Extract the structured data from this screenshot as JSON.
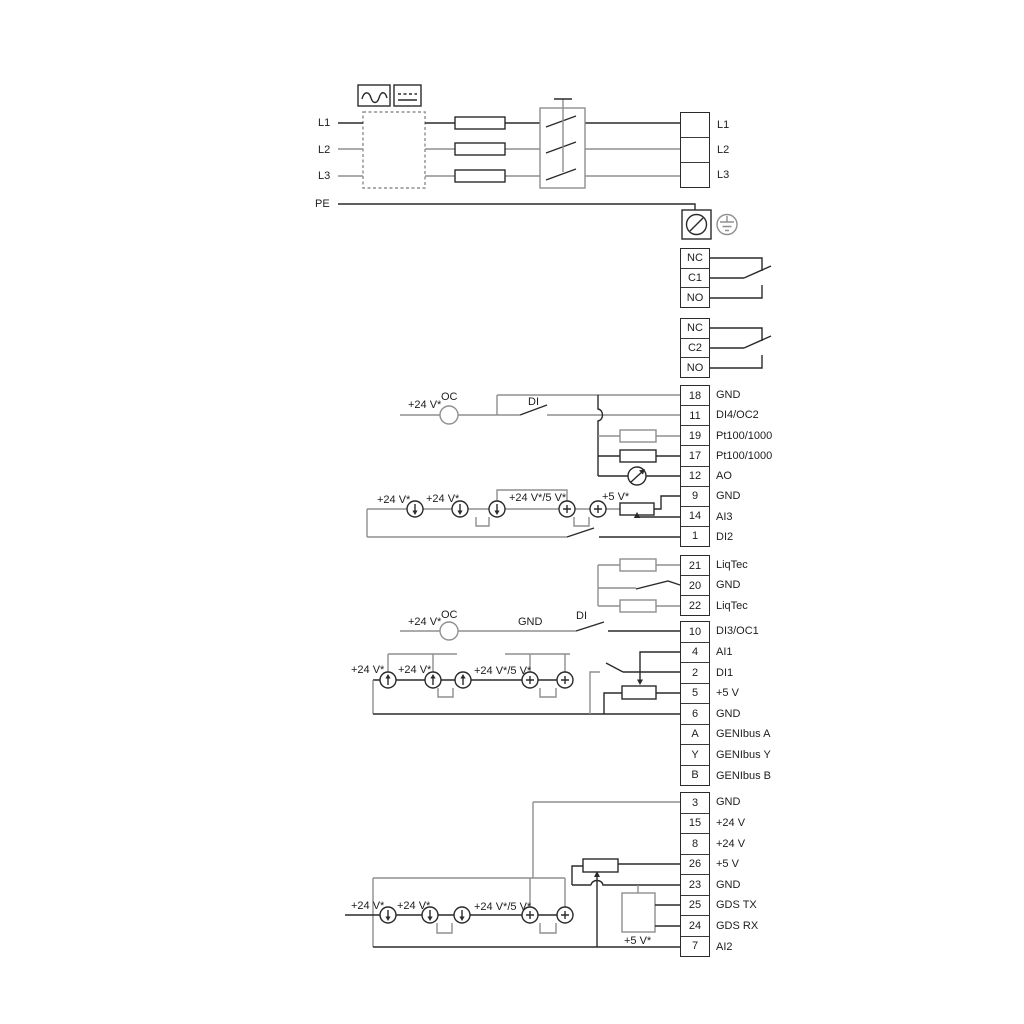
{
  "colors": {
    "background": "#ffffff",
    "wire_dark": "#2a2a2a",
    "wire_gray": "#8f8f8f"
  },
  "icons": {
    "converter_ac": "sine-wave-icon",
    "converter_dc": "dc-symbol-icon",
    "pe_gland": "cable-screw-terminal-icon",
    "earth": "earth-ground-icon",
    "analog_output": "meter-icon",
    "current_source": "current-source-icon"
  },
  "power": {
    "inputs": [
      {
        "label": "L1"
      },
      {
        "label": "L2"
      },
      {
        "label": "L3"
      },
      {
        "label": "PE"
      }
    ],
    "output_terminals": [
      "L1",
      "L2",
      "L3"
    ]
  },
  "blocks": {
    "relay1": {
      "cells": [
        "NC",
        "C1",
        "NO"
      ]
    },
    "relay2": {
      "cells": [
        "NC",
        "C2",
        "NO"
      ]
    },
    "io1": {
      "rows": [
        {
          "num": "18",
          "label": "GND"
        },
        {
          "num": "11",
          "label": "DI4/OC2"
        },
        {
          "num": "19",
          "label": "Pt100/1000"
        },
        {
          "num": "17",
          "label": "Pt100/1000"
        },
        {
          "num": "12",
          "label": "AO"
        },
        {
          "num": "9",
          "label": "GND"
        },
        {
          "num": "14",
          "label": "AI3"
        },
        {
          "num": "1",
          "label": "DI2"
        }
      ]
    },
    "liqtec": {
      "rows": [
        {
          "num": "21",
          "label": "LiqTec"
        },
        {
          "num": "20",
          "label": "GND"
        },
        {
          "num": "22",
          "label": "LiqTec"
        }
      ]
    },
    "io2": {
      "rows": [
        {
          "num": "10",
          "label": "DI3/OC1"
        },
        {
          "num": "4",
          "label": "AI1"
        },
        {
          "num": "2",
          "label": "DI1"
        },
        {
          "num": "5",
          "label": "+5 V"
        },
        {
          "num": "6",
          "label": "GND"
        },
        {
          "num": "A",
          "label": "GENIbus A"
        },
        {
          "num": "Y",
          "label": "GENIbus Y"
        },
        {
          "num": "B",
          "label": "GENIbus B"
        }
      ]
    },
    "io3": {
      "rows": [
        {
          "num": "3",
          "label": "GND"
        },
        {
          "num": "15",
          "label": "+24 V"
        },
        {
          "num": "8",
          "label": "+24 V"
        },
        {
          "num": "26",
          "label": "+5 V"
        },
        {
          "num": "23",
          "label": "GND"
        },
        {
          "num": "25",
          "label": "GDS TX"
        },
        {
          "num": "24",
          "label": "GDS RX"
        },
        {
          "num": "7",
          "label": "AI2"
        }
      ]
    }
  },
  "annotations": {
    "v24": "+24 V*",
    "v24v5": "+24 V*/5 V*",
    "v5": "+5 V*",
    "oc": "OC",
    "di": "DI",
    "gnd": "GND"
  }
}
